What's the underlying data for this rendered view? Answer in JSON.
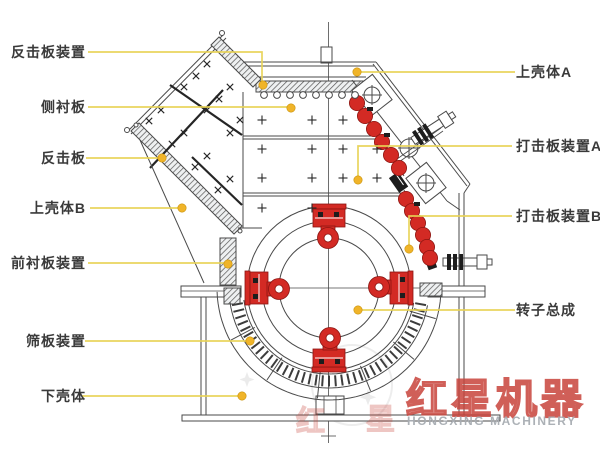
{
  "labels": {
    "left": [
      {
        "text": "反击板装置"
      },
      {
        "text": "侧衬板"
      },
      {
        "text": "反击板"
      },
      {
        "text": "上壳体B"
      },
      {
        "text": "前衬板装置"
      },
      {
        "text": "筛板装置"
      },
      {
        "text": "下壳体"
      }
    ],
    "right": [
      {
        "text": "上壳体A"
      },
      {
        "text": "打击板装置A"
      },
      {
        "text": "打击板装置B"
      },
      {
        "text": "转子总成"
      }
    ]
  },
  "watermark": {
    "brand_cn": "红星机器",
    "brand_en": "HONGXING MACHINERY",
    "ghost_char_1": "红",
    "ghost_char_2": "星"
  },
  "colors": {
    "background": "#FFFFFF",
    "leader": "#E8D355",
    "marker": "#F0B429",
    "red": "#D32A24",
    "red_dark": "#8C1511",
    "line": "#4A4A4A",
    "label_text": "#3A3A3A",
    "watermark_red": "#C8443C",
    "watermark_gray": "#A8ADB3"
  }
}
